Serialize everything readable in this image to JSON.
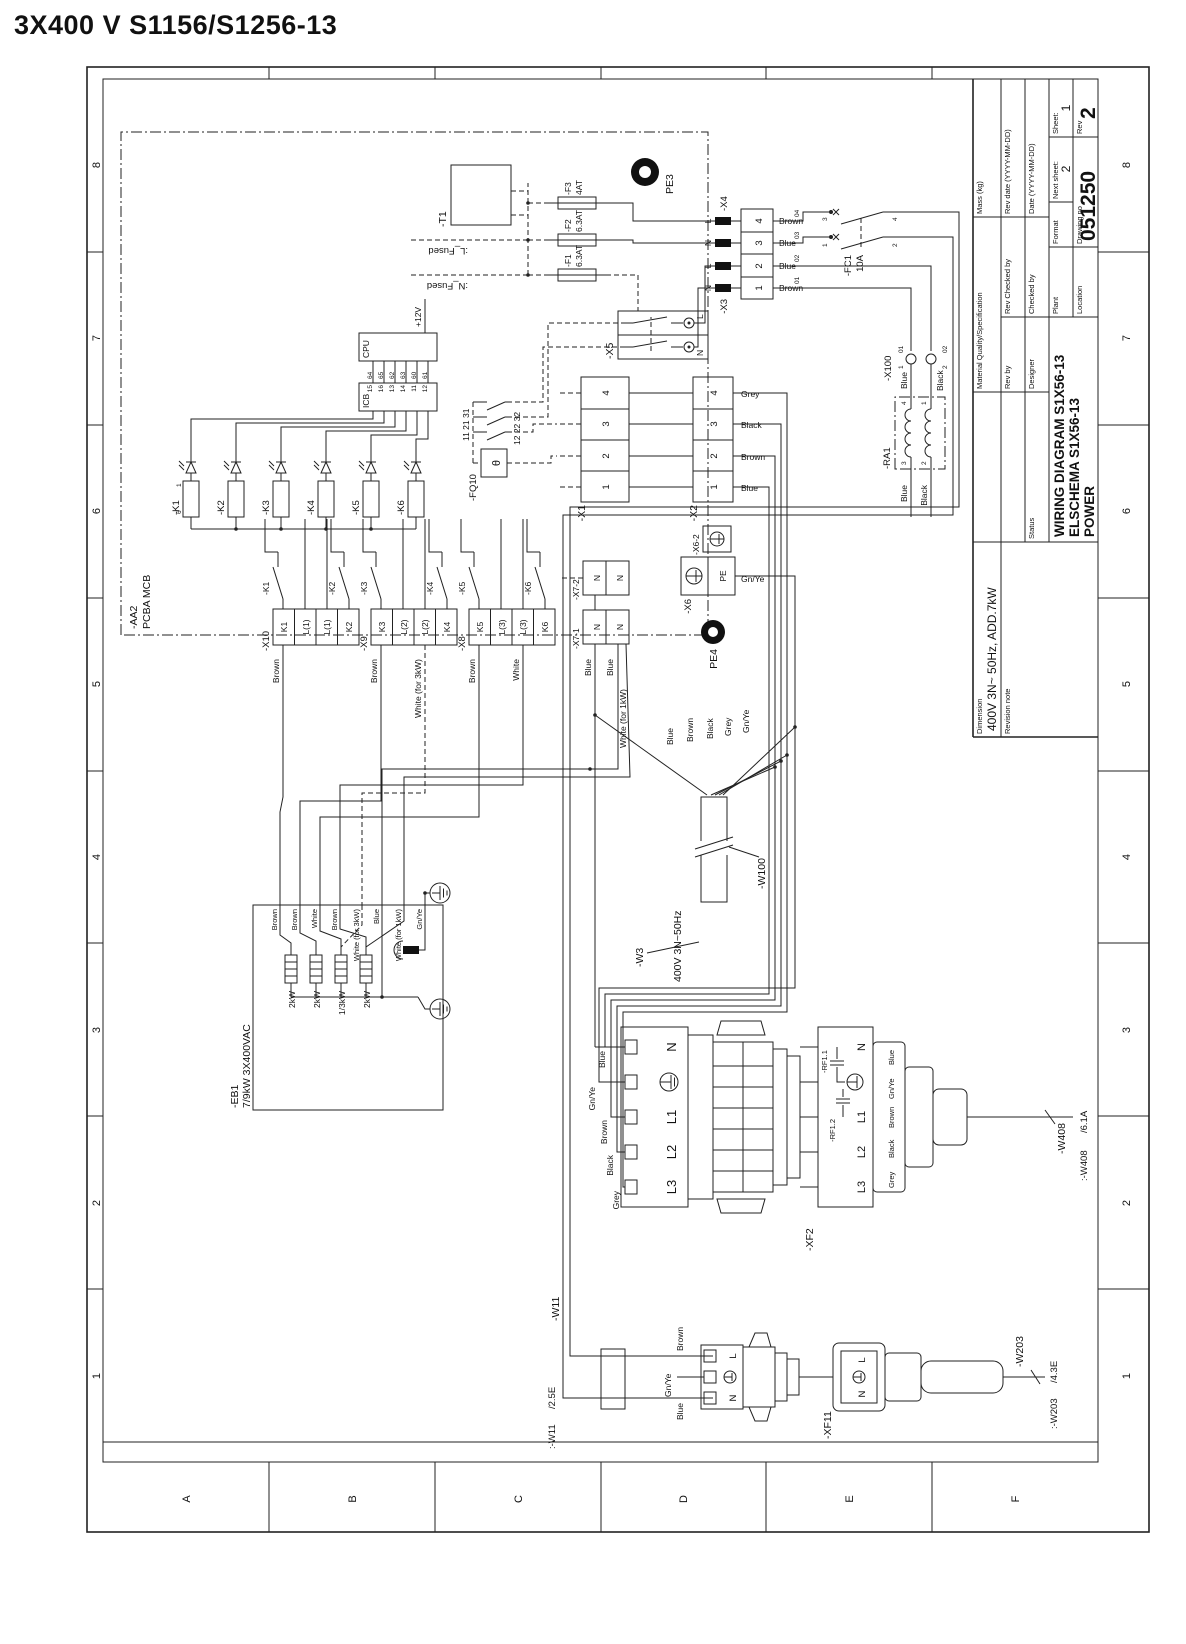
{
  "page": {
    "heading": "3X400 V S1156/S1256-13"
  },
  "frame": {
    "cols": [
      "1",
      "2",
      "3",
      "4",
      "5",
      "6",
      "7",
      "8"
    ],
    "rows": [
      "A",
      "B",
      "C",
      "D",
      "E",
      "F"
    ]
  },
  "tb": {
    "dimension_label": "Dimension",
    "dimension_value": "400V 3N~ 50Hz, ADD.7kW",
    "revision_note": "Revision note",
    "material": "Material Quality/Specification",
    "mass": "Mass (kg)",
    "rev_by": "Rev by",
    "rev_checked": "Rev Checked by",
    "rev_date": "Rev date (YYYY-MM-DD)",
    "designer": "Designer",
    "checked_by": "Checked by",
    "date": "Date (YYYY-MM-DD)",
    "status": "Status",
    "title1": "WIRING DIAGRAM S1X56-13",
    "title2": "ELSCHEMA S1X56-13",
    "title3": "POWER",
    "plant": "Plant",
    "format": "Format",
    "next_sheet_label": "Next sheet:",
    "next_sheet": "2",
    "sheet_label": "Sheet:",
    "sheet": "1",
    "location": "Location",
    "drawing_no_label": "Drawing no",
    "drawing_no": "051250",
    "rev_label": "Rev",
    "rev": "2"
  },
  "sch": {
    "aa2": "-AA2",
    "aa2_sub": "PCBA MCB",
    "t1": "-T1",
    "f1": "-F1",
    "f1_rating": "6.3AT",
    "f2": "-F2",
    "f2_rating": "6.3AT",
    "f3": "-F3",
    "f3_rating": "4AT",
    "l_fused": ":L_Fused",
    "n_fused": ":N_Fused",
    "pe3": "PE3",
    "pe4": "PE4",
    "x3": "-X3",
    "x4": "-X4",
    "pin_l": "L",
    "pin_n": "N",
    "plug": {
      "pins": [
        "1",
        "2",
        "3",
        "4"
      ],
      "colors": [
        "Brown",
        "Blue",
        "Blue",
        "Brown"
      ],
      "refs": [
        "01",
        "02",
        "03",
        "04"
      ]
    },
    "fc1": "-FC1",
    "fc1_rating": "10A",
    "fc1_terms": [
      "1",
      "2",
      "3",
      "4"
    ],
    "x100": "-X100",
    "x100_p1": "1",
    "x100_p2": "2",
    "x100_r1": "01",
    "x100_r2": "02",
    "ra1": "-RA1",
    "ra1_p1": "1",
    "ra1_p2": "2",
    "ra1_p3": "3",
    "ra1_p4": "4",
    "blue": "Blue",
    "black": "Black",
    "x5": "-X5",
    "x1": "-X1",
    "x2": "-X2",
    "conn_pins": [
      "1",
      "2",
      "3",
      "4"
    ],
    "x2_colors": [
      "Blue",
      "Brown",
      "Black",
      "Grey"
    ],
    "cpu": "CPU",
    "cpu_pins": [
      "64",
      "65",
      "62",
      "63",
      "60",
      "61"
    ],
    "icb": "ICB",
    "icb_pins": [
      "15",
      "16",
      "13",
      "14",
      "11",
      "12"
    ],
    "v12": "+12V",
    "fq10": "-FQ10",
    "theta": "θ",
    "fq10_ref1": "11 21 31",
    "fq10_ref2": "12 22 32",
    "relays": [
      "-K1",
      "-K2",
      "-K3",
      "-K4",
      "-K5",
      "-K6"
    ],
    "coil_p1": "1",
    "coil_p6": "6",
    "x10": "-X10",
    "x10_cells": [
      "K1",
      "L(1)",
      "L(1)",
      "K2"
    ],
    "x9": "-X9",
    "x9_cells": [
      "K3",
      "L(2)",
      "L(2)",
      "K4"
    ],
    "x8": "-X8",
    "x8_cells": [
      "K5",
      "L(3)",
      "L(3)",
      "K6"
    ],
    "x7_1": "-X7-1",
    "x7_2": "-X7-2",
    "n": "N",
    "x6": "-X6",
    "x6_2": "-X6-2",
    "pe": "PE",
    "gnye": "Gn/Ye",
    "exit_labels": [
      "Brown",
      "Brown",
      "White (for 3kW)",
      "Brown",
      "White",
      "Blue",
      "Blue",
      "White (for 1kW)"
    ],
    "eb1": "-EB1",
    "eb1_sub": "7/9kW  3X400VAC",
    "eb1_elements": [
      "2kW",
      "2kW",
      "1/3kW",
      "2kW"
    ],
    "eb1_inputs": [
      "Brown",
      "Brown",
      "White",
      "Brown",
      "White (for 3kW)",
      "Blue",
      "White (for 1kW)",
      "Gn/Ye"
    ],
    "w3": "-W3",
    "w100": "-W100",
    "mains": "400V 3N~50Hz",
    "fan_colors": [
      "Blue",
      "Brown",
      "Black",
      "Grey",
      "Gn/Ye"
    ],
    "xf2": "-XF2",
    "xf2_pins": [
      "L3",
      "L2",
      "L1",
      "N"
    ],
    "xf2_colors": [
      "Grey",
      "Black",
      "Brown",
      "Gn/Ye",
      "Blue"
    ],
    "rf11": "-RF1.1",
    "rf12": "-RF1.2",
    "w408": "-W408",
    "w408_ref": ":-W408",
    "w408_zone": "/6.1A",
    "xf11": "-XF11",
    "w11": "-W11",
    "w11_ref": ":-W11",
    "w11_zone": "/2.5E",
    "w203": "-W203",
    "w203_ref": ":-W203",
    "w203_zone": "/4.3E"
  }
}
